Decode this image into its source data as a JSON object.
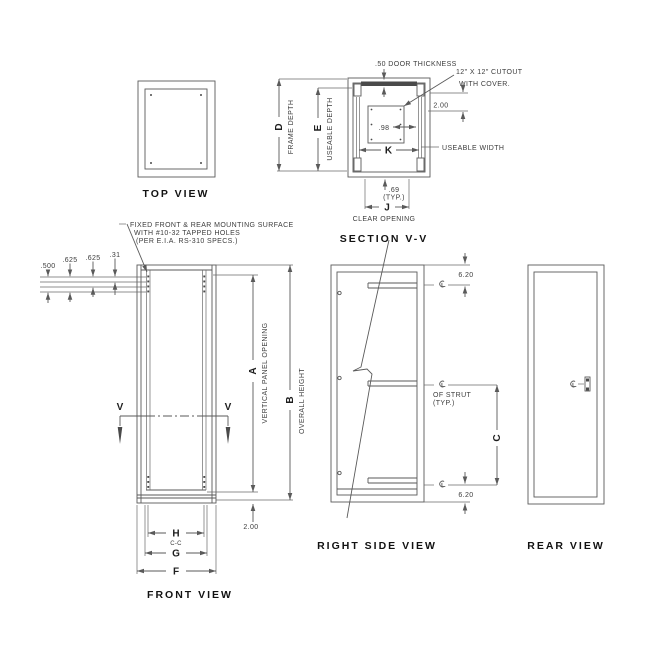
{
  "colors": {
    "line": "#5a5a5a",
    "text": "#3c3c3c",
    "title": "#121212",
    "background": "#ffffff"
  },
  "views": {
    "top": {
      "title": "TOP VIEW"
    },
    "section": {
      "title": "SECTION V-V",
      "door_thickness_note": ".50 DOOR THICKNESS",
      "cutout_note_1": "12\" X 12\" CUTOUT",
      "cutout_note_2": "WITH COVER.",
      "dim_cover_offset": "2.00",
      "dim_cutout_gap": ".98",
      "letter_useable_width": "K",
      "useable_width_label": "USEABLE WIDTH",
      "dim_flange": ".69",
      "dim_flange_typ": "(TYP.)",
      "letter_clear_opening": "J",
      "clear_opening_label": "CLEAR OPENING",
      "letter_frame_depth": "D",
      "frame_depth_label": "FRAME DEPTH",
      "letter_useable_depth": "E",
      "useable_depth_label": "USEABLE DEPTH"
    },
    "front": {
      "title": "FRONT VIEW",
      "mounting_note_1": "FIXED FRONT & REAR MOUNTING SURFACE",
      "mounting_note_2": "WITH #10-32 TAPPED HOLES",
      "mounting_note_3": "(PER E.I.A. RS-310 SPECS.)",
      "hole_dims": [
        ".500",
        ".625",
        ".625",
        ".31"
      ],
      "letter_panel_opening": "A",
      "panel_opening_label": "VERTICAL PANEL OPENING",
      "letter_overall_height": "B",
      "overall_height_label": "OVERALL HEIGHT",
      "dim_base": "2.00",
      "letter_h": "H",
      "h_sublabel": "C-C",
      "letter_g": "G",
      "letter_f": "F",
      "section_marker": "V"
    },
    "right_side": {
      "title": "RIGHT SIDE VIEW",
      "dim_strut_top": "6.20",
      "dim_strut_bottom": "6.20",
      "strut_note_1": "OF STRUT",
      "strut_note_2": "(TYP.)",
      "letter_strut_spacing": "C"
    },
    "rear": {
      "title": "REAR VIEW"
    }
  }
}
